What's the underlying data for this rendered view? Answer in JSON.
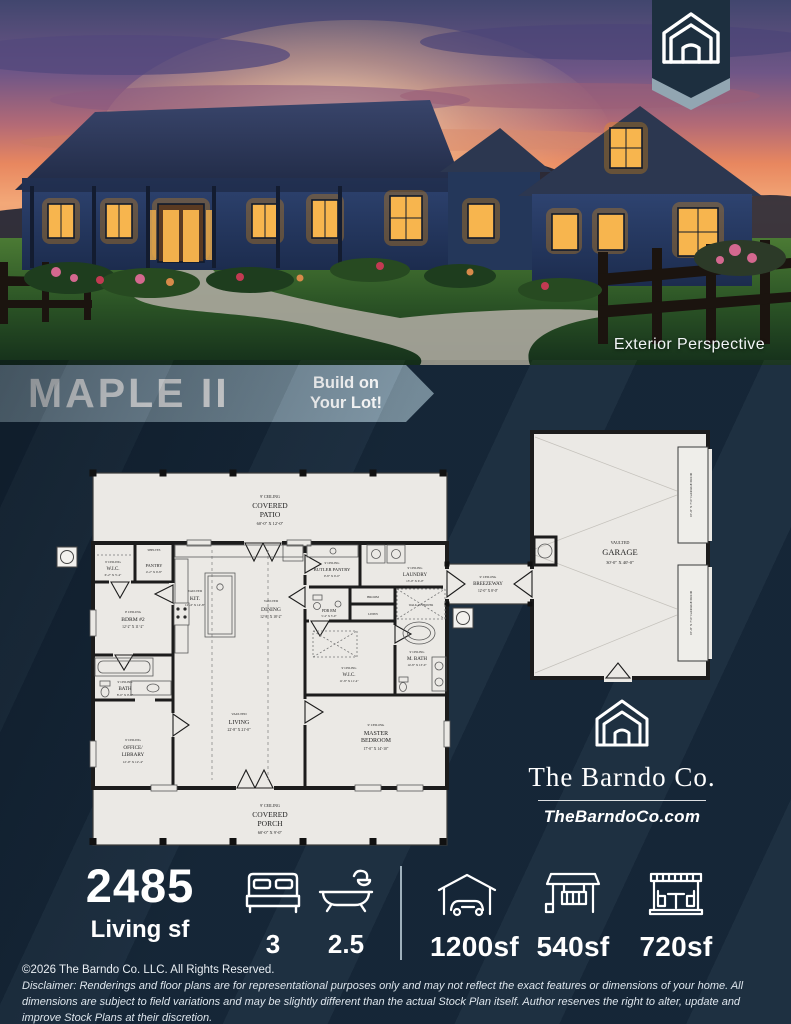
{
  "colors": {
    "background_navy": "#17293b",
    "banner_band": "#7d95a4",
    "plan_paper": "#ebe9e5",
    "window_glow": "#f7b54e",
    "text_white": "#ffffff"
  },
  "photo": {
    "caption": "Exterior Perspective"
  },
  "banner": {
    "title": "MAPLE II",
    "tag_line1": "Build on",
    "tag_line2": "Your Lot!"
  },
  "plan": {
    "rooms": {
      "patio": {
        "ceiling": "9' CEILING",
        "line1": "COVERED",
        "line2": "PATIO",
        "dims": "60'-0\" X 12'-0\""
      },
      "porch": {
        "ceiling": "9' CEILING",
        "line1": "COVERED",
        "line2": "PORCH",
        "dims": "60'-0\" X 9'-0\""
      },
      "garage": {
        "ceiling": "VAULTED",
        "line1": "GARAGE",
        "dims": "30'-0\" X 40'-0\""
      },
      "garage_door": "16'-0\" X 7'-0\" GARAGE DOOR",
      "breezeway": {
        "ceiling": "9' CEILING",
        "line1": "BREEZEWAY",
        "dims": "12'-0\" X 8'-0\""
      },
      "wic2": {
        "ceiling": "9' CEILING",
        "line1": "W.I.C.",
        "dims": "6'-2\" X 5'-4\""
      },
      "pantry": {
        "line1": "PANTRY",
        "dims": "4'-2\" X 6'-8\""
      },
      "bdrm2": {
        "ceiling": "9' CEILING",
        "line1": "BDRM #2",
        "dims": "12'-2\" X 11'-2\""
      },
      "kitchen": {
        "ceiling": "VAULTED",
        "line1": "KIT.",
        "dims": "12'-4\" X 14'-8\""
      },
      "dining": {
        "ceiling": "VAULTED",
        "line1": "DINING",
        "dims": "12'-8\" X 18'-2\""
      },
      "butler": {
        "ceiling": "9' CEILING",
        "line1": "BUTLER PANTRY",
        "dims": "9'-8\" X 6'-0\""
      },
      "laundry": {
        "ceiling": "9' CEILING",
        "line1": "LAUNDRY",
        "dims": "13'-0\" X 6'-0\""
      },
      "pdr": {
        "line1": "PDR RM",
        "dims": "5'-4\" X 5'-0\""
      },
      "broom": "BROOM",
      "linen": "LINEN",
      "bath": {
        "ceiling": "9' CEILING",
        "line1": "BATH",
        "dims": "8'-0\" X 9'-0\""
      },
      "office": {
        "ceiling": "9' CEILING",
        "line1": "OFFICE/",
        "line2": "LIBRARY",
        "dims": "12'-0\" X 12'-4\""
      },
      "living": {
        "ceiling": "VAULTED",
        "line1": "LIVING",
        "dims": "22'-8\" X 21'-0\""
      },
      "mwic": {
        "ceiling": "9' CEILING",
        "line1": "W.I.C.",
        "dims": "11'-8\" X 11'-4\""
      },
      "mbath": {
        "ceiling": "9' CEILING",
        "line1": "M. BATH",
        "dims": "14'-8\" X 13'-0\""
      },
      "master": {
        "ceiling": "9' CEILING",
        "line1": "MASTER",
        "line2": "BEDROOM",
        "dims": "17'-0\" X 14'-10\""
      },
      "shelves": "SHELVES",
      "shower": "WALK-IN SHOWER"
    }
  },
  "brand": {
    "name": "The Barndo Co.",
    "url": "TheBarndoCo.com"
  },
  "stats": {
    "living_value": "2485",
    "living_label": "Living sf",
    "beds": "3",
    "baths": "2.5",
    "garage_sf": "1200sf",
    "porch_sf": "540sf",
    "patio_sf": "720sf"
  },
  "footer": {
    "copyright": "©2026 The Barndo Co. LLC. All Rights Reserved.",
    "disclaimer": "Disclaimer: Renderings and floor plans are for representational purposes only and may not reflect the exact features or dimensions of your home. All dimensions are subject to field variations and may be slightly different than the actual Stock Plan itself. Author reserves the right to alter, update and improve Stock Plans at their discretion."
  }
}
